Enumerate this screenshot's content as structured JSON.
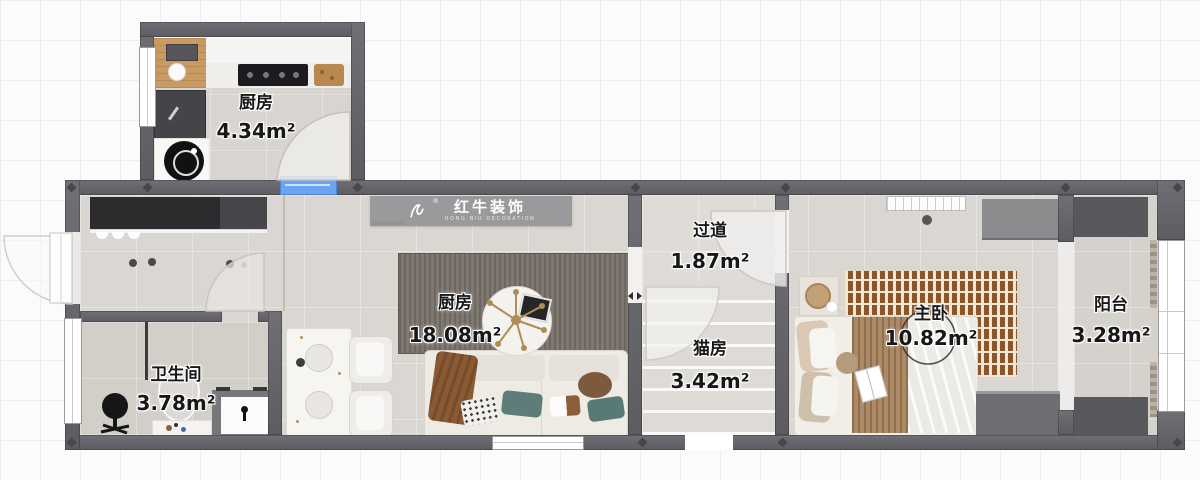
{
  "watermark": {
    "name": "红牛装饰",
    "subtitle": "HONG NIU DECORATION",
    "reg": "®"
  },
  "rooms": {
    "kitchen_annex": {
      "name": "厨房",
      "area": "4.34m²"
    },
    "living": {
      "name": "厨房",
      "area": "18.08m²"
    },
    "hallway": {
      "name": "过道",
      "area": "1.87m²"
    },
    "cat_room": {
      "name": "猫房",
      "area": "3.42m²"
    },
    "master_bedroom": {
      "name": "主卧",
      "area": "10.82m²"
    },
    "balcony": {
      "name": "阳台",
      "area": "3.28m²"
    },
    "bathroom": {
      "name": "卫生间",
      "area": "3.78m²"
    }
  },
  "colors": {
    "wall": "#636367",
    "window_blue": "#6ca4f2",
    "floor": "#dad6d1",
    "living_rug": "#736c64",
    "bedroom_rug_brick": "#8b572a",
    "banner": "#97979a"
  }
}
